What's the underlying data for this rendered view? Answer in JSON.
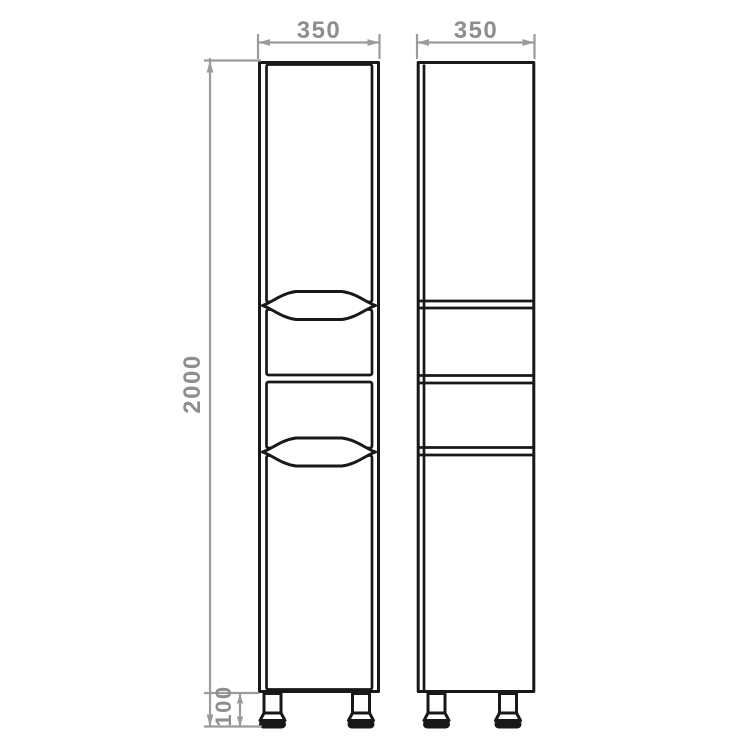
{
  "labels": {
    "front_width": "350",
    "side_depth": "350",
    "overall_height": "2000",
    "leg_height": "100"
  },
  "colors": {
    "background": "#ffffff",
    "outline": "#181818",
    "dimension_line": "#9b9b9b",
    "dimension_text": "#8e8e8e"
  }
}
